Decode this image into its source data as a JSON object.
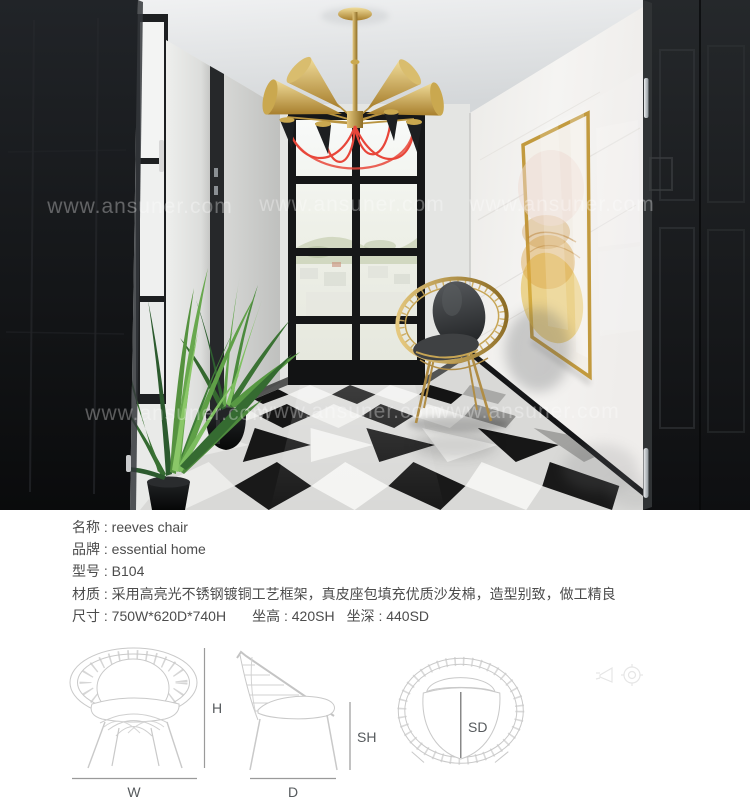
{
  "photo": {
    "watermark": "www.ansuner.com"
  },
  "specs": {
    "separator": " : ",
    "rows": [
      {
        "label": "名称",
        "value": "reeves chair"
      },
      {
        "label": "品牌",
        "value": "essential home"
      },
      {
        "label": "型号",
        "value": "B104"
      },
      {
        "label": "材质",
        "value": "采用高亮光不锈钢镀铜工艺框架，真皮座包填充优质沙发棉，造型别致，做工精良"
      },
      {
        "label": "尺寸",
        "value": "750W*620D*740H",
        "extras": [
          {
            "label": "坐高",
            "value": "420SH"
          },
          {
            "label": "坐深",
            "value": "440SD"
          }
        ]
      }
    ]
  },
  "drawings": {
    "front": {
      "width_label": "W",
      "height_label": "H"
    },
    "side": {
      "depth_label": "D",
      "seat_height_label": "SH"
    },
    "top": {
      "seat_depth_label": "SD"
    }
  },
  "colors": {
    "text": "#4c4c4c",
    "drawing_line": "#c9c9c9",
    "dimension_line": "#9a9a9a",
    "gold_accent": "#c2a15c",
    "watermark": "#ffffff"
  }
}
